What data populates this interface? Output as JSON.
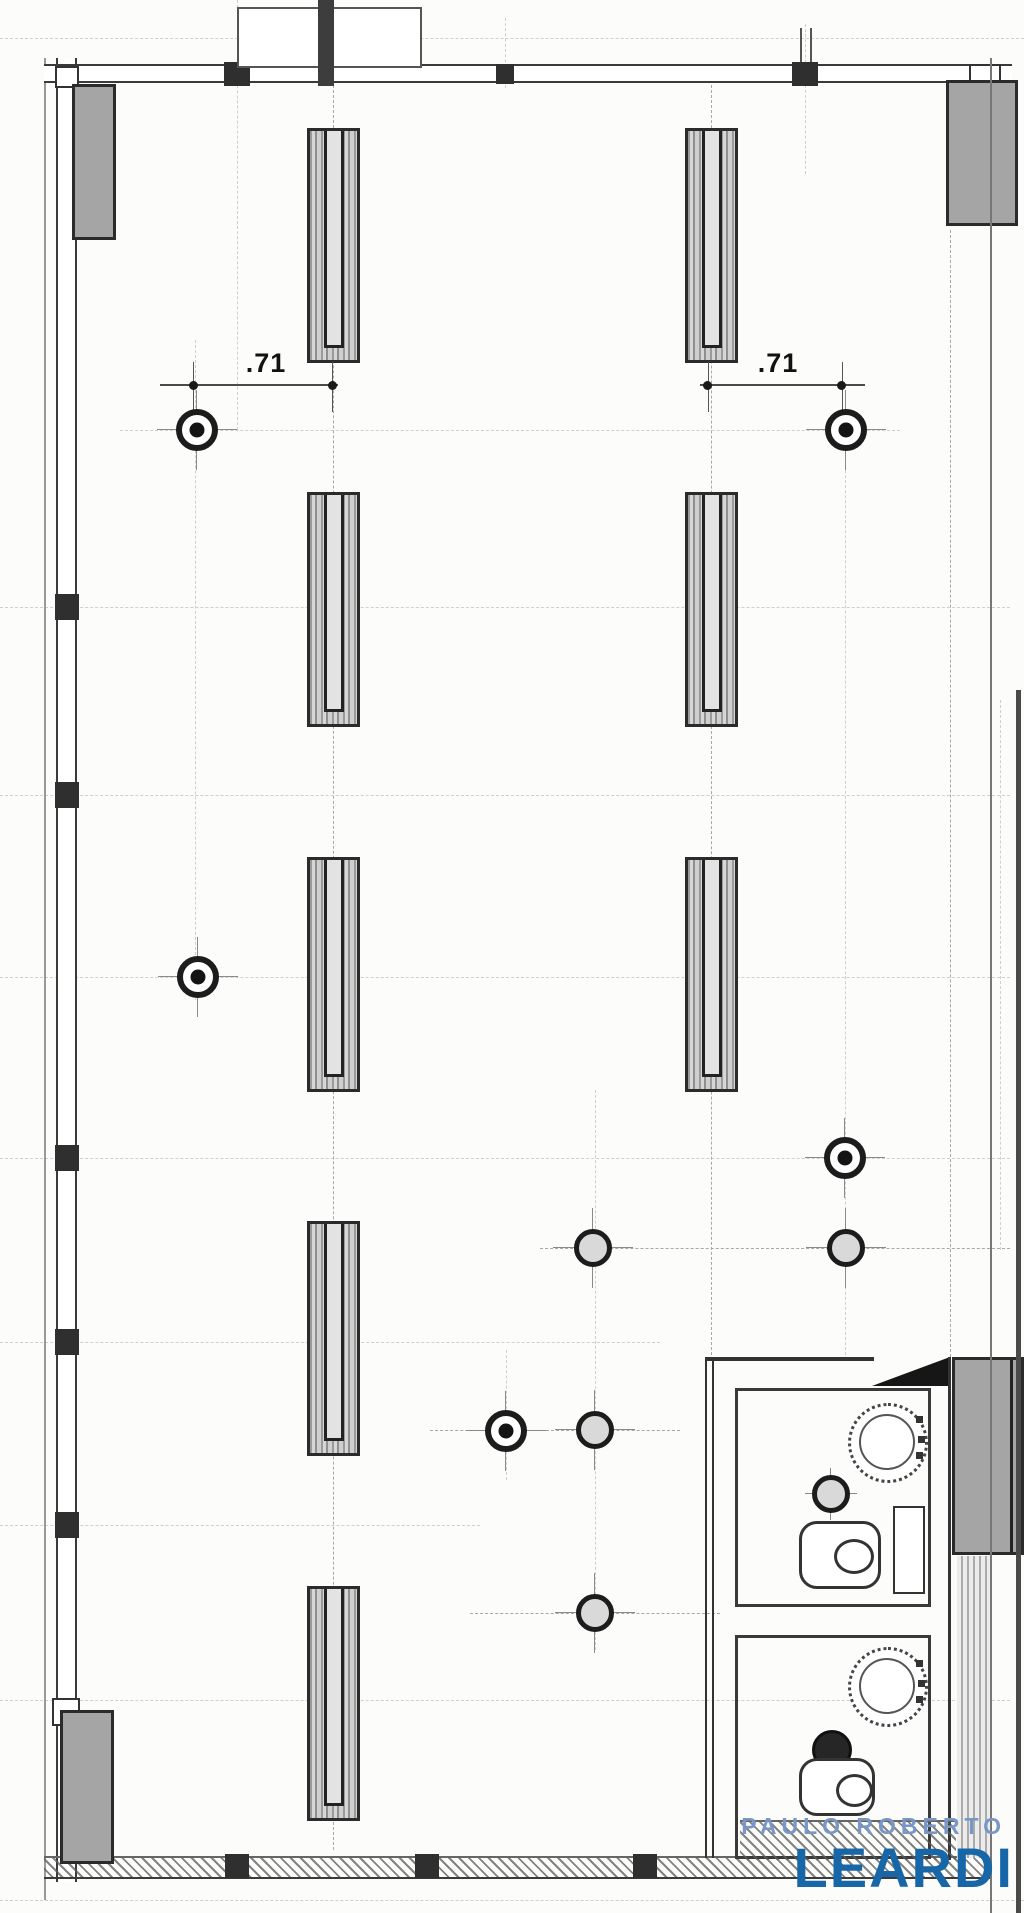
{
  "drawing": {
    "type": "architectural-floor-plan",
    "dimensions": [
      {
        "label": ".71"
      },
      {
        "label": ".71"
      }
    ],
    "watermark": {
      "line1": "PAULO ROBERTO",
      "line2": "LEARDI"
    },
    "legend_icons": [
      "structural-column-hatched",
      "column-marker-bullseye",
      "column-marker-crosshair",
      "concrete-pillar",
      "sink",
      "toilet",
      "floor-drain"
    ]
  },
  "colors": {
    "logo_primary": "#1767a8",
    "logo_secondary": "#7897c7",
    "pillar_gray": "#a5a5a5",
    "line_dark": "#2b2b2b"
  }
}
